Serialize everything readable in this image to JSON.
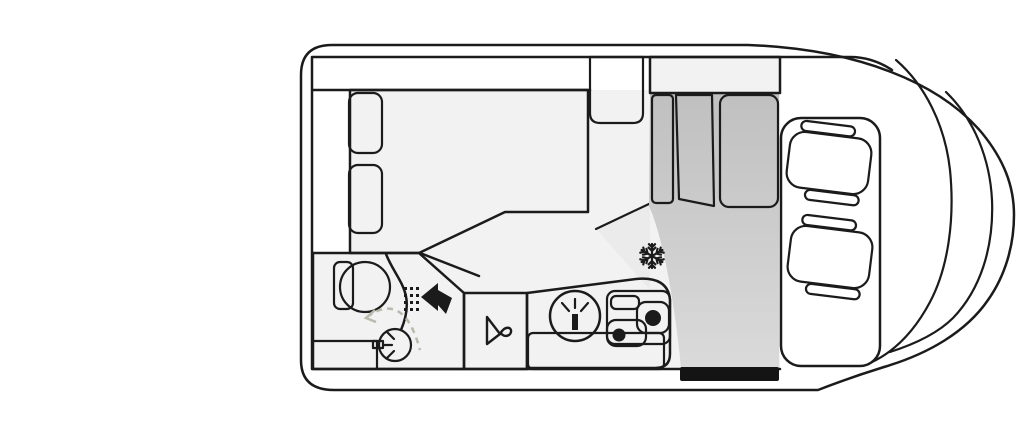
{
  "meta": {
    "diagram": "campervan-floorplan-top-view",
    "orientation": "rear-left-front-right"
  },
  "colors": {
    "outline": "#1b1b1b",
    "body_fill": "#fcfcfc",
    "floor": "#f2f2f3",
    "white": "#ffffff",
    "bed": "#f5f2d8",
    "wet_zone": "#e9e38d",
    "cabinet_gray": "#cccccc",
    "door_gray": "#c3c3c3",
    "entry_gray_top": "#c0c0c0",
    "entry_gray_bottom": "#dadada",
    "seat_fill": "#ececec",
    "step_black": "#141414",
    "swing_dash": "#b9b9ac",
    "shade_wedge": "#ebebec"
  },
  "rooms": [
    {
      "name": "rear-bed",
      "features": [
        "double-bed",
        "pillow",
        "pillow",
        "overhead-strip"
      ]
    },
    {
      "name": "bathroom",
      "features": [
        "toilet",
        "washbasin",
        "shower-head",
        "swivel-wall",
        "door-swing"
      ]
    },
    {
      "name": "wardrobe",
      "features": [
        "clothes-hanger"
      ]
    },
    {
      "name": "kitchen",
      "features": [
        "sink",
        "two-burner-stove",
        "worktop-flap",
        "refrigerator"
      ]
    },
    {
      "name": "entryway",
      "features": [
        "sliding-door-step",
        "tall-cabinet-doors"
      ]
    },
    {
      "name": "cab",
      "features": [
        "driver-seat",
        "passenger-seat",
        "windshield"
      ]
    }
  ],
  "icons": [
    {
      "name": "fridge-snowflake-icon",
      "meaning": "refrigerator / freezer position"
    },
    {
      "name": "shower-head-icon",
      "meaning": "shower location"
    },
    {
      "name": "faucet-icon",
      "meaning": "water tap"
    },
    {
      "name": "clothes-hanger-icon",
      "meaning": "wardrobe"
    },
    {
      "name": "door-swing-arc",
      "meaning": "bathroom door swivel direction"
    }
  ]
}
